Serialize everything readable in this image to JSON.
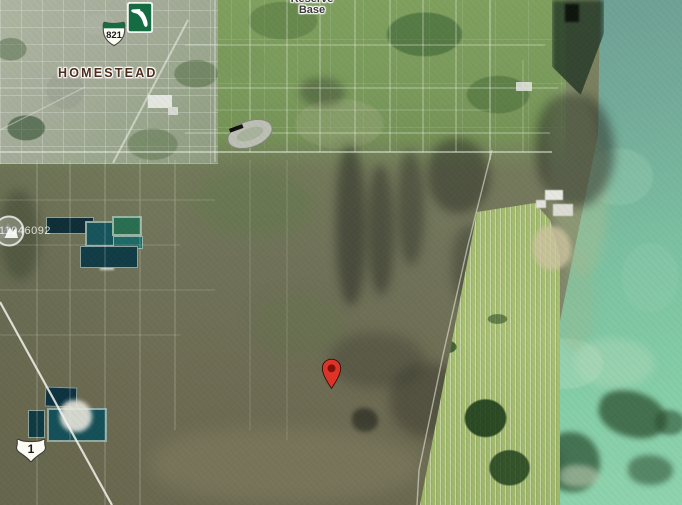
{
  "map": {
    "view": "satellite",
    "labels": {
      "homestead": "HOMESTEAD",
      "reserve_base_line1": "Reserve",
      "reserve_base_line2": "Base"
    },
    "shields": {
      "turnpike_821": "821",
      "us_route_1": "1"
    },
    "watermark": "A11046092",
    "marker": {
      "x": 331,
      "y": 390
    },
    "colors": {
      "pin": "#dd3427",
      "pin_center": "#7d120c",
      "turnpike_green": "#156c43",
      "water": "#7cc3a2",
      "field": "#a8bf74",
      "label_homestead": "#4e2d1e",
      "label_reserve": "#3a3a38"
    },
    "icons": {
      "turnpike_logo": "florida-turnpike-icon",
      "route_821": "route-shield-821-icon",
      "route_us1": "us-route-1-shield-icon",
      "marker": "location-pin-icon",
      "watermark_logo": "watermark-logo-icon"
    }
  }
}
